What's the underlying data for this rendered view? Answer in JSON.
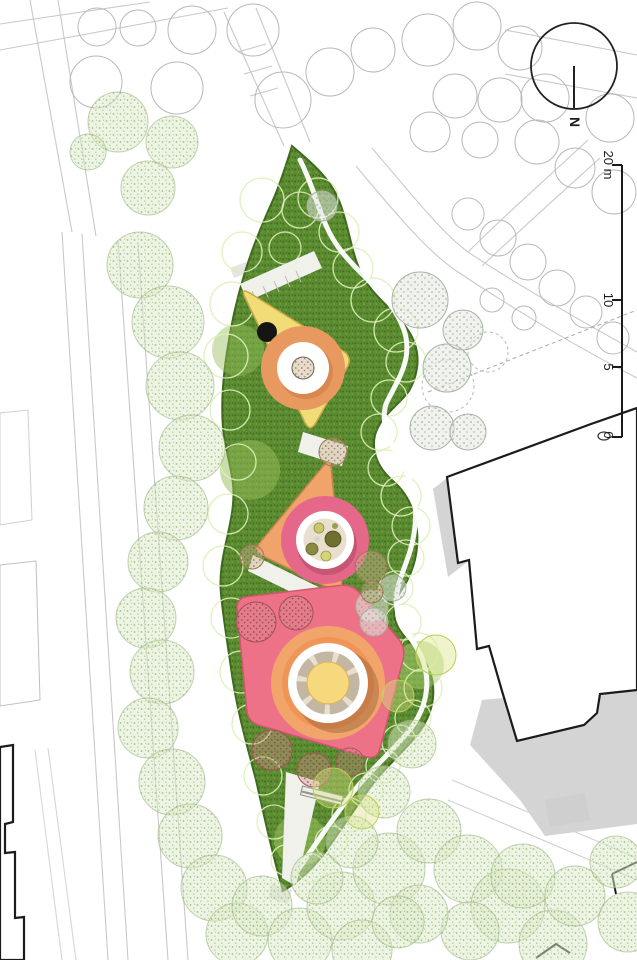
{
  "north": {
    "label": "N"
  },
  "scale_bar": {
    "labels": [
      "20 m",
      "10",
      "5",
      "0"
    ]
  },
  "palette": {
    "paper": "#FFFFFF",
    "line_faint": "#C9C9C9",
    "outline_dark": "#1B1B1B",
    "band_green": "#5C8C31",
    "band_green_edge": "#3F6A1E",
    "canopy_stroke": "#DDF0B8",
    "tree_light_dot": "#8FB573",
    "tree_gray_dot": "#96A48E",
    "tree_red_dot": "#8E3B40",
    "tree_tan_dot": "#7F5F3C",
    "plaza_yellow": "#F2DC77",
    "plaza_orange": "#F0A46B",
    "plaza_pink": "#ED7287",
    "ring_orange": "#E89960",
    "circle_pink": "#E5688A",
    "halo_orange": "#F2A869",
    "inner_beige": "#E9DFCE",
    "center_yellow": "#F6D97C",
    "shadow_gray": "#D4D4D4",
    "path_white": "#FFFFFF"
  }
}
